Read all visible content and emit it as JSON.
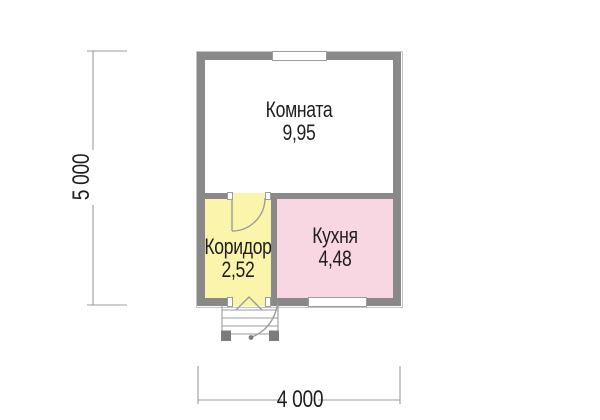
{
  "rooms": [
    {
      "name": "Комната",
      "area": "9,95",
      "fill": "#ffffff"
    },
    {
      "name": "Коридор",
      "area": "2,52",
      "fill": "#fbf5ab"
    },
    {
      "name": "Кухня",
      "area": "4,48",
      "fill": "#f8d7e2"
    }
  ],
  "dimensions": {
    "height_label": "5 000",
    "width_label": "4 000"
  },
  "colors": {
    "wall": "#898989",
    "line": "#9c9c9c",
    "post": "#7c7c7c",
    "text": "#1e1e1e",
    "window": "#ffffff",
    "bg": "#ffffff"
  }
}
